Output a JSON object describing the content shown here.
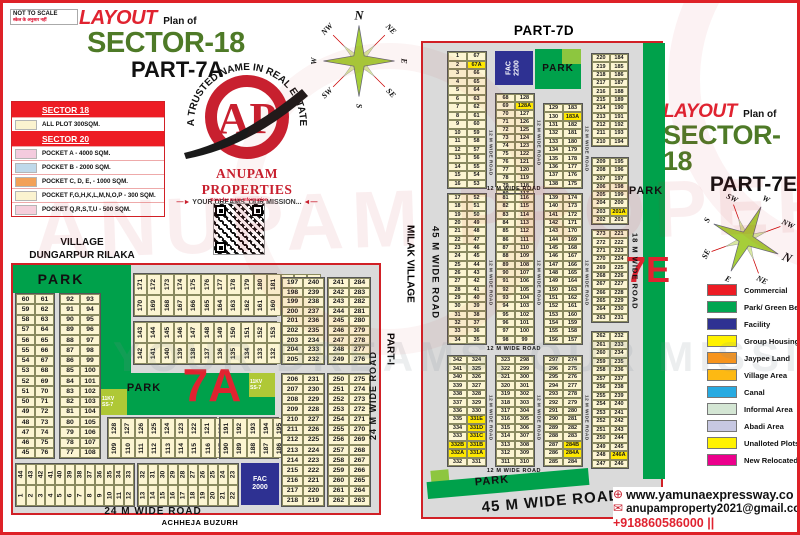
{
  "meta": {
    "not_to_scale": "NOT TO SCALE",
    "note": "स्केल के अनुसार नहीं"
  },
  "titles": {
    "left": {
      "layout": "LAYOUT",
      "plan": "Plan of",
      "sector": "SECTOR-18",
      "part": "PART-7A"
    },
    "right": {
      "layout": "LAYOUT",
      "plan": "Plan of",
      "sector": "SECTOR-18",
      "part": "PART-7E"
    },
    "part7d": "PART-7D"
  },
  "logo": {
    "arc": "A TRUSTED NAME IN REAL ESTATE",
    "monogram": "AP",
    "company": "ANUPAM PROPERTIES",
    "slogan": "YOUR DREAMS, OUR MISSION...",
    "qr_caption": "Scan for more Information"
  },
  "village": {
    "line1": "VILLAGE",
    "line2": "DUNGARPUR RILAKA"
  },
  "outside": {
    "achheja": "ACHHEJA BUZURH",
    "part1": "PART-I",
    "milak": "MILAK VILLAGE"
  },
  "watermarks": {
    "brand": "ANUPAM PROPERTIES",
    "slogan": "YOUR DREAMS, OUR MISSION"
  },
  "legend_left": {
    "sections": [
      {
        "header": "SECTOR 18",
        "rows": [
          {
            "c": "#FBF3D0",
            "t": "ALL PLOT  300SQM."
          }
        ]
      },
      {
        "header": "SECTOR 20",
        "rows": [
          {
            "c": "#F4CBDE",
            "t": "POCKET A    -   4000 SQM."
          },
          {
            "c": "#BFD9EA",
            "t": "POCKET B    -   2000 SQM."
          },
          {
            "c": "#F2A158",
            "t": "POCKET C, D, E, - 1000 SQM."
          },
          {
            "c": "#FBF3D0",
            "t": "POCKET   F,G,H,K,L,M,N,O,P  -  300 SQM."
          },
          {
            "c": "#F6CFDC",
            "t": "POCKET Q,R,S,T,U   -  500 SQM."
          }
        ]
      }
    ]
  },
  "legend_right": {
    "items": [
      {
        "c": "#ED1C24",
        "t": "Commercial"
      },
      {
        "c": "#00A651",
        "t": "Park/ Green Belt"
      },
      {
        "c": "#2E3192",
        "t": "Facility"
      },
      {
        "c": "#FFF200",
        "t": "Group Housing"
      },
      {
        "c": "#F7941D",
        "t": "Jaypee Land"
      },
      {
        "c": "#FDB913",
        "t": "Village Area"
      },
      {
        "c": "#27AAE1",
        "t": "Canal"
      },
      {
        "c": "#D4E6D4",
        "t": "Informal Area"
      },
      {
        "c": "#C7C8E2",
        "t": "Abadi Area"
      },
      {
        "c": "#FFF200",
        "t": "Unalloted Plots"
      },
      {
        "c": "#EC008C",
        "t": "New Relocated Plots"
      }
    ]
  },
  "contact": {
    "website": "www.yamunaexpressway.co",
    "email": "anupamproperty2021@gmail.com",
    "phones": "+918860586000 || +918860736000"
  },
  "highlights": [
    "67A",
    "128A",
    "183A",
    "201A",
    "246A",
    "284A",
    "284B",
    "331A",
    "331B",
    "331C",
    "331D",
    "331E",
    "332A",
    "332B"
  ],
  "compass1": {
    "cx": 44,
    "cy": 56,
    "r": 45,
    "rot": 0,
    "labels": [
      {
        "t": "N",
        "a": 0,
        "big": 1
      },
      {
        "t": "NE",
        "a": 45,
        "tilt": 45
      },
      {
        "t": "E",
        "a": 90,
        "tilt": 90
      },
      {
        "t": "SE",
        "a": 135,
        "tilt": 45
      },
      {
        "t": "S",
        "a": 180,
        "tilt": 90
      },
      {
        "t": "SW",
        "a": 225,
        "tilt": -45
      },
      {
        "t": "W",
        "a": 270,
        "tilt": -90
      },
      {
        "t": "NW",
        "a": 315,
        "tilt": -45
      }
    ]
  },
  "compass2": {
    "cx": 56,
    "cy": 50,
    "r": 44,
    "rot": 115,
    "labels": [
      {
        "t": "W",
        "a": 25,
        "tilt": 25
      },
      {
        "t": "NW",
        "a": 70,
        "tilt": 25
      },
      {
        "t": "N",
        "a": 115,
        "tilt": 25,
        "big": 1
      },
      {
        "t": "NE",
        "a": 160,
        "tilt": 25
      },
      {
        "t": "E",
        "a": 205,
        "tilt": 25
      },
      {
        "t": "SE",
        "a": 250,
        "tilt": -65
      },
      {
        "t": "S",
        "a": 295,
        "tilt": -65
      },
      {
        "t": "SW",
        "a": 340,
        "tilt": 25
      }
    ]
  },
  "left_map": {
    "zones": [
      {
        "cls": "z-green",
        "name": "park-top",
        "x": 0,
        "y": 0,
        "w": 106,
        "h": 28
      },
      {
        "cls": "z-green",
        "name": "park-vertical",
        "x": 88,
        "y": 0,
        "w": 30,
        "h": 150
      },
      {
        "cls": "z-green",
        "name": "park-7a",
        "x": 88,
        "y": 108,
        "w": 174,
        "h": 42
      },
      {
        "cls": "z-kv",
        "name": "substation-11kv-left",
        "x": 88,
        "y": 124,
        "w": 26,
        "h": 26,
        "l": "11KV\nSS-7"
      },
      {
        "cls": "z-kv",
        "name": "substation-11kv-right",
        "x": 236,
        "y": 108,
        "w": 26,
        "h": 24,
        "l": "11KV\nSS-7"
      },
      {
        "cls": "z-fac",
        "name": "fac-2000",
        "x": 228,
        "y": 198,
        "w": 38,
        "h": 42,
        "l": "FAC\n2000"
      }
    ],
    "labels": [
      {
        "t": "PARK",
        "x": 12,
        "y": 2,
        "w": 72,
        "h": 24,
        "cls": "lab-park-lg"
      },
      {
        "t": "PARK",
        "x": 106,
        "y": 112,
        "w": 50,
        "h": 22,
        "cls": "lab-park-md"
      },
      {
        "t": "7A",
        "x": 154,
        "y": 92,
        "w": 90,
        "h": 56,
        "cls": "lab-7a"
      },
      {
        "t": "24 M WIDE ROAD",
        "x": 50,
        "y": 240,
        "w": 180,
        "h": 12,
        "cls": "road-h"
      },
      {
        "t": "24 M WIDE ROAD",
        "x": 352,
        "y": 55,
        "w": 16,
        "h": 150,
        "cls": "road-v"
      }
    ],
    "blocks": [
      {
        "name": "block-45-76",
        "x": 2,
        "y": 28,
        "w": 38,
        "h": 164,
        "rows": "60|61,59|62,58|63,57|64,56|65,55|66,54|67,53|68,52|69,51|70,50|71,49|72,48|73,47|74,46|75,45|76"
      },
      {
        "name": "block-77-108",
        "x": 46,
        "y": 28,
        "w": 40,
        "h": 164,
        "rows": "92|93,91|94,90|95,89|96,88|97,87|98,86|99,85|100,84|101,83|102,82|103,81|104,80|105,79|106,78|107,77|108"
      },
      {
        "name": "strip-157-184",
        "x": 120,
        "y": 8,
        "w": 142,
        "h": 42,
        "top": "171,172,173,174,175,176,177,178,179,180,181,182,183,184",
        "bottom": "170,169,168,167,166,165,164,163,162,161,160,159,158,157"
      },
      {
        "name": "strip-129-156",
        "x": 120,
        "y": 56,
        "w": 142,
        "h": 42,
        "top": "143,144,145,146,147,148,149,150,151,152,153,154,155,156",
        "bottom": "142,141,140,139,138,137,136,135,134,133,132,131,130,129"
      },
      {
        "name": "strip-109-128",
        "x": 94,
        "y": 152,
        "w": 108,
        "h": 40,
        "top": "128,127,126,125,124,123,122,121,120,119",
        "bottom": "109,110,111,112,113,114,115,116,117,118"
      },
      {
        "name": "strip-185-196",
        "x": 206,
        "y": 152,
        "w": 58,
        "h": 40,
        "top": "191,192,193,194,195,196",
        "bottom": "190,189,188,187,186,185"
      },
      {
        "name": "strip-1-12",
        "x": 2,
        "y": 198,
        "w": 118,
        "h": 42,
        "top": "44,43,42,41,40,39,38,37,36,35,34,33",
        "bottom": "1,2,3,4,5,6,7,8,9,10,11,12"
      },
      {
        "name": "strip-13-22",
        "x": 124,
        "y": 198,
        "w": 100,
        "h": 42,
        "top": "32,31,30,29,28,27,26,25,24,23",
        "bottom": "13,14,15,16,17,18,19,20,21,22"
      },
      {
        "name": "block-197-240",
        "x": 268,
        "y": 12,
        "w": 42,
        "h": 86,
        "rows": "197|240,198|239,199|238,200|237,201|236,202|235,203|234,204|233,205|232"
      },
      {
        "name": "block-241-284",
        "x": 314,
        "y": 12,
        "w": 42,
        "h": 86,
        "rows": "241|284,242|283,243|282,244|281,245|280,246|279,247|278,248|277,249|276"
      },
      {
        "name": "block-206-231",
        "x": 268,
        "y": 108,
        "w": 42,
        "h": 132,
        "rows": "206|231,207|230,208|229,209|228,210|227,211|226,212|225,213|224,214|223,215|222,216|221,217|220,218|219"
      },
      {
        "name": "block-250-275",
        "x": 314,
        "y": 108,
        "w": 42,
        "h": 132,
        "rows": "250|275,251|274,252|273,253|272,254|271,255|270,256|269,257|268,258|267,259|266,260|265,261|264,262|263"
      }
    ]
  },
  "right_map": {
    "zones": [
      {
        "cls": "z-fac rot",
        "name": "fac-2200",
        "x": 72,
        "y": 8,
        "w": 38,
        "h": 34,
        "l": "FAC\n2200"
      },
      {
        "cls": "z-green",
        "name": "park-top",
        "x": 112,
        "y": 6,
        "w": 46,
        "h": 40
      },
      {
        "cls": "z-lightgreen",
        "name": "green-patch-top",
        "x": 139,
        "y": 6,
        "w": 19,
        "h": 15
      },
      {
        "cls": "z-green",
        "name": "green-belt-strip",
        "x": 220,
        "y": 0,
        "w": 22,
        "h": 436
      },
      {
        "cls": "z-lightgreen",
        "name": "green-patch-bottom",
        "x": 8,
        "y": 427,
        "w": 18,
        "h": 15,
        "rot": -5
      },
      {
        "cls": "z-green",
        "name": "park-diagonal",
        "x": 4,
        "y": 432,
        "w": 162,
        "h": 17,
        "rot": -5
      }
    ],
    "labels": [
      {
        "t": "PARK",
        "x": 112,
        "y": 16,
        "w": 46,
        "h": 18,
        "cls": "lab-park-sm"
      },
      {
        "t": "PARK",
        "x": 201,
        "y": 140,
        "w": 44,
        "h": 16,
        "cls": "lab-park-md"
      },
      {
        "t": "7E",
        "x": 205,
        "y": 205,
        "w": 40,
        "h": 44,
        "cls": "lab-7e"
      },
      {
        "t": "PARK",
        "x": 42,
        "y": 430,
        "w": 54,
        "h": 16,
        "cls": "lab-park-md",
        "rot": -5
      },
      {
        "t": "45 M WIDE ROAD",
        "x": 22,
        "y": 447,
        "w": 212,
        "h": 22,
        "cls": "road-big",
        "rot": -5
      },
      {
        "t": "45 M WIDE ROAD",
        "x": 2,
        "y": 150,
        "w": 20,
        "h": 160,
        "cls": "road-v-down big"
      },
      {
        "t": "18 M WIDE ROAD",
        "x": 205,
        "y": 158,
        "w": 14,
        "h": 140,
        "cls": "road-v-down"
      },
      {
        "t": "12 M WIDE ROAD",
        "x": 24,
        "y": 142,
        "w": 134,
        "h": 8,
        "cls": "road-h-sm"
      },
      {
        "t": "12 M WIDE ROAD",
        "x": 24,
        "y": 302,
        "w": 134,
        "h": 8,
        "cls": "road-h-sm"
      },
      {
        "t": "12 M WIDE ROAD",
        "x": 24,
        "y": 424,
        "w": 134,
        "h": 8,
        "cls": "road-h-sm"
      },
      {
        "t": "12 M WIDE ROAD",
        "x": 62,
        "y": 80,
        "w": 10,
        "h": 60,
        "cls": "road-v-sm"
      },
      {
        "t": "12 M WIDE ROAD",
        "x": 62,
        "y": 190,
        "w": 10,
        "h": 100,
        "cls": "road-v-sm"
      },
      {
        "t": "12 M WIDE ROAD",
        "x": 62,
        "y": 330,
        "w": 10,
        "h": 90,
        "cls": "road-v-sm"
      },
      {
        "t": "12 M WIDE ROAD",
        "x": 110,
        "y": 60,
        "w": 10,
        "h": 80,
        "cls": "road-v-sm"
      },
      {
        "t": "12 M WIDE ROAD",
        "x": 110,
        "y": 190,
        "w": 10,
        "h": 100,
        "cls": "road-v-sm"
      },
      {
        "t": "12 M WIDE ROAD",
        "x": 110,
        "y": 330,
        "w": 10,
        "h": 90,
        "cls": "road-v-sm"
      },
      {
        "t": "12 M WIDE ROAD",
        "x": 158,
        "y": 66,
        "w": 10,
        "h": 80,
        "cls": "road-v-sm"
      },
      {
        "t": "12 M WIDE ROAD",
        "x": 158,
        "y": 190,
        "w": 10,
        "h": 100,
        "cls": "road-v-sm"
      },
      {
        "t": "12 M WIDE ROAD",
        "x": 158,
        "y": 330,
        "w": 10,
        "h": 90,
        "cls": "road-v-sm"
      }
    ],
    "blocks": [
      {
        "name": "block-1-67",
        "x": 24,
        "y": 8,
        "w": 38,
        "h": 136,
        "rows": "1|67,2|67A,3|66,4|65,5|64,6|63,7|62,8|61,9|60,10|59,11|58,12|57,13|56,14|55,15|54,16|53"
      },
      {
        "name": "block-17-52",
        "x": 24,
        "y": 150,
        "w": 38,
        "h": 150,
        "rows": "17|52,18|51,19|50,20|49,21|48,22|47,23|46,24|45,25|44,26|43,27|42,28|41,29|40,30|39,31|38,32|37,33|36,34|35"
      },
      {
        "name": "block-68-128",
        "x": 72,
        "y": 50,
        "w": 38,
        "h": 92,
        "rows": "68|128,69|128A,70|127,71|126,72|125,73|124,74|123,75|122,76|121,77|120,78|119,79|118,80|117"
      },
      {
        "name": "block-81-116",
        "x": 72,
        "y": 150,
        "w": 38,
        "h": 150,
        "rows": "81|116,82|115,83|114,84|113,85|112,86|111,87|110,88|109,89|108,90|107,91|106,92|105,93|104,94|103,95|102,96|101,97|100,98|99"
      },
      {
        "name": "block-129-183",
        "x": 120,
        "y": 60,
        "w": 38,
        "h": 84,
        "rows": "129|183,130|183A,131|182,132|181,133|180,134|179,135|178,136|177,137|176,138|175"
      },
      {
        "name": "block-139-174",
        "x": 120,
        "y": 150,
        "w": 38,
        "h": 150,
        "rows": "139|174,140|173,141|172,142|171,143|170,144|169,145|168,146|167,147|166,148|165,149|164,150|163,151|162,152|161,153|160,154|159,155|158,156|157"
      },
      {
        "name": "block-210-220",
        "x": 168,
        "y": 10,
        "w": 36,
        "h": 92,
        "rows": "220|184,219|185,218|186,217|187,216|188,215|189,214|190,213|191,212|192,211|193,210|194"
      },
      {
        "name": "block-202-209",
        "x": 168,
        "y": 114,
        "w": 36,
        "h": 66,
        "rows": "209|195,208|196,207|197,206|198,205|199,204|200,203|201A,202|201"
      },
      {
        "name": "block-263-273",
        "x": 168,
        "y": 186,
        "w": 36,
        "h": 92,
        "rows": "273|221,272|222,271|223,270|224,269|225,268|226,267|227,266|228,265|229,264|230,263|231"
      },
      {
        "name": "block-247-262",
        "x": 168,
        "y": 288,
        "w": 36,
        "h": 136,
        "rows": "262|232,261|233,260|234,259|235,258|236,257|237,256|238,255|239,254|240,253|241,252|242,251|243,250|244,249|245,248|246A,247|246"
      },
      {
        "name": "block-332-342",
        "x": 24,
        "y": 312,
        "w": 38,
        "h": 110,
        "rows": "342|324,341|325,340|326,339|327,338|328,337|329,336|330,335|331E,334|331D,333|331C,332B|331B,332A|331A,332|331"
      },
      {
        "name": "block-311-323",
        "x": 72,
        "y": 312,
        "w": 38,
        "h": 110,
        "rows": "323|298,322|299,321|300,320|301,319|302,318|303,317|304,316|305,315|306,314|307,313|308,312|309,311|310"
      },
      {
        "name": "block-285-297",
        "x": 120,
        "y": 312,
        "w": 38,
        "h": 110,
        "rows": "297|274,296|275,295|276,294|277,293|278,292|279,291|280,290|281,289|282,288|283,287|284B,286|284A,285|284"
      }
    ]
  }
}
